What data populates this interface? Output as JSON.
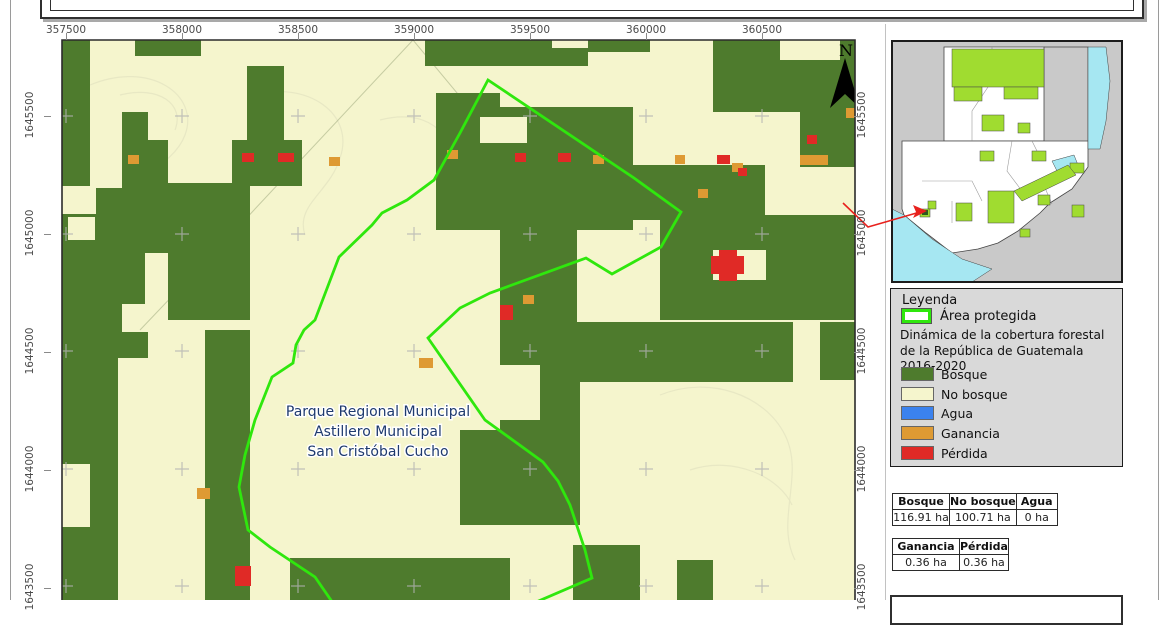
{
  "page": {
    "bg": "#ffffff",
    "border_color": "#9a9a9a"
  },
  "map": {
    "frame": {
      "x": 62,
      "y": 40,
      "w": 793,
      "h": 560
    },
    "colors": {
      "forest": "#4e7b2d",
      "no_forest": "#f5f5cd",
      "water": "#3b82ee",
      "gain": "#de9a33",
      "loss": "#e02a26",
      "boundary": "#2fe70d",
      "grid_cross": "#b3b3b3",
      "contour": "#e7e7c3",
      "road": "#97a478",
      "border": "#2b2b2b",
      "label_color": "#1e3a6e"
    },
    "x_axis": {
      "ticks": [
        {
          "label": "357500",
          "x": 66
        },
        {
          "label": "358000",
          "x": 182
        },
        {
          "label": "358500",
          "x": 298
        },
        {
          "label": "359000",
          "x": 414
        },
        {
          "label": "359500",
          "x": 530
        },
        {
          "label": "360000",
          "x": 646
        },
        {
          "label": "360500",
          "x": 762
        }
      ]
    },
    "y_axis": {
      "ticks": [
        {
          "label": "1645500",
          "y": 116
        },
        {
          "label": "1645000",
          "y": 234
        },
        {
          "label": "1644500",
          "y": 352
        },
        {
          "label": "1644000",
          "y": 470
        },
        {
          "label": "1643500",
          "y": 588
        }
      ]
    },
    "grid_xs": [
      66,
      182,
      298,
      414,
      530,
      646,
      762
    ],
    "grid_ys": [
      116,
      234,
      351,
      469,
      586
    ],
    "forest_rects": [
      [
        62,
        40,
        28,
        146
      ],
      [
        135,
        40,
        66,
        16
      ],
      [
        232,
        140,
        70,
        46
      ],
      [
        142,
        183,
        108,
        70
      ],
      [
        168,
        227,
        82,
        93
      ],
      [
        205,
        330,
        45,
        270
      ],
      [
        247,
        66,
        37,
        78
      ],
      [
        436,
        93,
        90,
        137
      ],
      [
        460,
        107,
        173,
        123
      ],
      [
        600,
        165,
        165,
        55
      ],
      [
        500,
        227,
        77,
        95
      ],
      [
        500,
        322,
        80,
        200
      ],
      [
        460,
        430,
        120,
        95
      ],
      [
        290,
        558,
        220,
        42
      ],
      [
        573,
        545,
        67,
        55
      ],
      [
        713,
        40,
        142,
        100
      ],
      [
        800,
        140,
        55,
        27
      ],
      [
        660,
        215,
        195,
        105
      ],
      [
        543,
        322,
        250,
        60
      ],
      [
        820,
        322,
        35,
        58
      ],
      [
        677,
        560,
        36,
        40
      ]
    ],
    "forest_polys": [
      [
        [
          62,
          214
        ],
        [
          96,
          214
        ],
        [
          96,
          188
        ],
        [
          122,
          188
        ],
        [
          122,
          112
        ],
        [
          148,
          112
        ],
        [
          148,
          140
        ],
        [
          168,
          140
        ],
        [
          168,
          188
        ],
        [
          148,
          188
        ],
        [
          148,
          224
        ],
        [
          168,
          224
        ],
        [
          168,
          252
        ],
        [
          145,
          252
        ],
        [
          145,
          304
        ],
        [
          122,
          304
        ],
        [
          122,
          332
        ],
        [
          148,
          332
        ],
        [
          148,
          358
        ],
        [
          118,
          358
        ],
        [
          118,
          600
        ],
        [
          62,
          600
        ],
        [
          62,
          527
        ],
        [
          90,
          527
        ],
        [
          90,
          464
        ],
        [
          62,
          464
        ]
      ],
      [
        [
          425,
          40
        ],
        [
          650,
          40
        ],
        [
          650,
          52
        ],
        [
          588,
          52
        ],
        [
          588,
          66
        ],
        [
          425,
          66
        ]
      ]
    ],
    "cream_rects": [
      [
        780,
        40,
        60,
        20
      ],
      [
        500,
        66,
        60,
        41
      ],
      [
        480,
        117,
        47,
        26
      ],
      [
        713,
        250,
        53,
        30
      ],
      [
        68,
        217,
        27,
        23
      ],
      [
        485,
        365,
        55,
        55
      ],
      [
        510,
        527,
        63,
        73
      ],
      [
        252,
        540,
        12,
        60
      ],
      [
        265,
        558,
        10,
        42
      ],
      [
        275,
        543,
        43,
        15
      ],
      [
        713,
        112,
        87,
        46
      ],
      [
        552,
        40,
        36,
        8
      ]
    ],
    "gain_rects": [
      [
        128,
        155,
        11,
        9
      ],
      [
        329,
        157,
        11,
        9
      ],
      [
        447,
        150,
        11,
        9
      ],
      [
        593,
        155,
        11,
        9
      ],
      [
        675,
        155,
        10,
        9
      ],
      [
        698,
        189,
        10,
        9
      ],
      [
        732,
        163,
        11,
        9
      ],
      [
        800,
        155,
        28,
        10
      ],
      [
        846,
        108,
        12,
        10
      ],
      [
        523,
        295,
        11,
        9
      ],
      [
        419,
        358,
        14,
        10
      ],
      [
        197,
        488,
        13,
        11
      ]
    ],
    "loss_rects": [
      [
        242,
        153,
        12,
        9
      ],
      [
        278,
        153,
        16,
        9
      ],
      [
        515,
        153,
        11,
        9
      ],
      [
        558,
        153,
        13,
        9
      ],
      [
        717,
        155,
        13,
        9
      ],
      [
        807,
        135,
        10,
        9
      ],
      [
        738,
        168,
        9,
        8
      ],
      [
        500,
        305,
        13,
        15
      ],
      [
        235,
        566,
        16,
        20
      ],
      [
        711,
        256,
        33,
        18
      ],
      [
        719,
        250,
        18,
        31
      ]
    ],
    "protected_area_pts": [
      [
        488,
        80
      ],
      [
        634,
        178
      ],
      [
        681,
        212
      ],
      [
        661,
        247
      ],
      [
        612,
        274
      ],
      [
        586,
        258
      ],
      [
        490,
        293
      ],
      [
        460,
        308
      ],
      [
        428,
        338
      ],
      [
        485,
        420
      ],
      [
        543,
        462
      ],
      [
        558,
        481
      ],
      [
        570,
        505
      ],
      [
        585,
        550
      ],
      [
        592,
        578
      ],
      [
        527,
        606
      ],
      [
        440,
        614
      ],
      [
        335,
        606
      ],
      [
        315,
        577
      ],
      [
        270,
        547
      ],
      [
        248,
        530
      ],
      [
        239,
        487
      ],
      [
        245,
        455
      ],
      [
        255,
        420
      ],
      [
        272,
        377
      ],
      [
        293,
        363
      ],
      [
        296,
        345
      ],
      [
        304,
        330
      ],
      [
        315,
        320
      ],
      [
        339,
        257
      ],
      [
        372,
        225
      ],
      [
        382,
        213
      ],
      [
        407,
        200
      ],
      [
        434,
        180
      ],
      [
        460,
        133
      ]
    ],
    "contour_paths": [
      "M90,85 C150,60 200,95 185,135 C172,170 120,180 112,215",
      "M250,95 C310,80 355,115 340,158 C330,192 295,205 305,235",
      "M380,120 C425,108 455,132 448,165",
      "M660,395 C710,375 765,395 785,435 C805,475 775,520 795,560",
      "M690,470 C735,455 780,478 792,505",
      "M120,95 C160,85 185,105 175,130"
    ],
    "road_paths": [
      "M413,40 L240,225 L140,330",
      "M413,40 L492,135"
    ],
    "place_label": {
      "lines": [
        "Parque Regional Municipal",
        "Astillero Municipal",
        "San Cristóbal Cucho"
      ],
      "x": 378,
      "y": 416,
      "line_height": 20
    },
    "north_label": "N"
  },
  "inset": {
    "frame": {
      "x": 892,
      "y": 41,
      "w": 230,
      "h": 241
    },
    "colors": {
      "bg": "#c9c9c9",
      "country": "#ffffff",
      "protected": "#a0dc30",
      "water": "#a6e7f2",
      "outline": "#444444",
      "dept_line": "#8a8a8a",
      "leader": "#e8211d",
      "target": "#2d5a1e"
    },
    "country_polys": [
      [
        [
          52,
          6
        ],
        [
          152,
          6
        ],
        [
          152,
          100
        ],
        [
          52,
          100
        ]
      ],
      [
        [
          10,
          100
        ],
        [
          196,
          100
        ],
        [
          196,
          126
        ],
        [
          180,
          148
        ],
        [
          158,
          162
        ],
        [
          148,
          172
        ],
        [
          126,
          190
        ],
        [
          106,
          202
        ],
        [
          86,
          208
        ],
        [
          60,
          212
        ],
        [
          34,
          192
        ],
        [
          12,
          174
        ],
        [
          10,
          168
        ]
      ]
    ],
    "lime_rects": [
      [
        60,
        8,
        92,
        38
      ],
      [
        62,
        46,
        28,
        14
      ],
      [
        112,
        46,
        34,
        12
      ],
      [
        90,
        74,
        22,
        16
      ],
      [
        126,
        82,
        12,
        10
      ],
      [
        88,
        110,
        14,
        10
      ],
      [
        140,
        110,
        14,
        10
      ],
      [
        96,
        150,
        26,
        32
      ],
      [
        64,
        162,
        16,
        18
      ],
      [
        36,
        160,
        8,
        8
      ],
      [
        146,
        154,
        12,
        10
      ],
      [
        178,
        122,
        14,
        10
      ],
      [
        180,
        164,
        12,
        12
      ],
      [
        128,
        188,
        10,
        8
      ],
      [
        28,
        168,
        10,
        8
      ]
    ],
    "lime_polys": [
      [
        [
          122,
          150
        ],
        [
          176,
          124
        ],
        [
          184,
          134
        ],
        [
          130,
          160
        ]
      ]
    ],
    "water_polys": [
      [
        [
          196,
          6
        ],
        [
          214,
          6
        ],
        [
          218,
          40
        ],
        [
          214,
          80
        ],
        [
          208,
          108
        ],
        [
          196,
          108
        ]
      ],
      [
        [
          160,
          120
        ],
        [
          182,
          114
        ],
        [
          186,
          124
        ],
        [
          166,
          132
        ]
      ],
      [
        [
          0,
          168
        ],
        [
          12,
          174
        ],
        [
          40,
          198
        ],
        [
          70,
          218
        ],
        [
          100,
          228
        ],
        [
          80,
          241
        ],
        [
          0,
          241
        ]
      ]
    ],
    "belize_line": "M152,6 L196,6 L196,100",
    "dept_lines": [
      [
        [
          100,
          6
        ],
        [
          100,
          40
        ],
        [
          80,
          70
        ],
        [
          80,
          100
        ]
      ],
      [
        [
          30,
          140
        ],
        [
          80,
          140
        ],
        [
          90,
          160
        ]
      ],
      [
        [
          120,
          100
        ],
        [
          115,
          130
        ],
        [
          130,
          150
        ]
      ],
      [
        [
          140,
          100
        ],
        [
          150,
          120
        ]
      ],
      [
        [
          160,
          163
        ],
        [
          150,
          140
        ]
      ],
      [
        [
          60,
          160
        ],
        [
          60,
          182
        ]
      ]
    ],
    "target_rect": [
      30,
      169,
      6,
      5
    ],
    "leader_pts": [
      [
        843,
        203
      ],
      [
        868,
        227
      ],
      [
        920,
        212
      ]
    ],
    "leader_head": [
      [
        927,
        211
      ],
      [
        913,
        205
      ],
      [
        916,
        212
      ],
      [
        913,
        218
      ]
    ]
  },
  "legend": {
    "title": "Leyenda",
    "protected_label": "Área protegida",
    "subtitle": "Dinámica de la cobertura forestal de la República de Guatemala 2016-2020",
    "items": [
      {
        "label": "Bosque",
        "color": "#4e7b2d"
      },
      {
        "label": "No bosque",
        "color": "#f5f5cd"
      },
      {
        "label": "Agua",
        "color": "#3b82ee"
      },
      {
        "label": "Ganancia",
        "color": "#de9a33"
      },
      {
        "label": "Pérdida",
        "color": "#e02a26"
      }
    ],
    "item_tops": [
      366,
      386,
      405,
      425,
      445
    ]
  },
  "tables": {
    "t1": {
      "headers": [
        "Bosque",
        "No bosque",
        "Agua"
      ],
      "values": [
        "116.91 ha",
        "100.71 ha",
        "0 ha"
      ],
      "col_widths": [
        56,
        65,
        40
      ]
    },
    "t2": {
      "headers": [
        "Ganancia",
        "Pérdida"
      ],
      "values": [
        "0.36 ha",
        "0.36 ha"
      ],
      "col_widths": [
        66,
        45
      ]
    }
  }
}
